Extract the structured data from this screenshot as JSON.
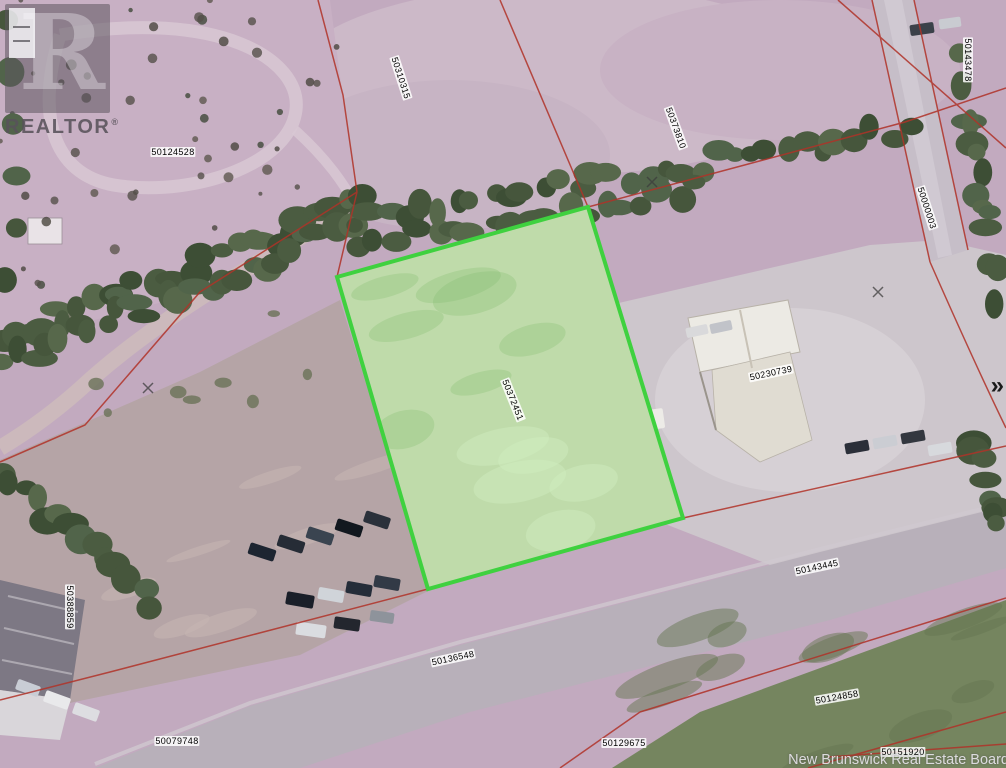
{
  "map": {
    "type": "aerial-parcel-map",
    "boundary_color": "#b03228",
    "highlight_parcel": {
      "id": "50372451",
      "border_color": "#3fd13f",
      "fill_color": "rgba(165,225,140,0.45)"
    },
    "parcel_labels": [
      {
        "id": "50124528",
        "x": 173,
        "y": 152,
        "rot": 0
      },
      {
        "id": "50310315",
        "x": 401,
        "y": 78,
        "rot": 72
      },
      {
        "id": "50373810",
        "x": 676,
        "y": 128,
        "rot": 70
      },
      {
        "id": "50143478",
        "x": 968,
        "y": 60,
        "rot": 90
      },
      {
        "id": "50000003",
        "x": 927,
        "y": 208,
        "rot": 72
      },
      {
        "id": "50230739",
        "x": 771,
        "y": 373,
        "rot": -12
      },
      {
        "id": "50372451",
        "x": 513,
        "y": 400,
        "rot": 68
      },
      {
        "id": "50388859",
        "x": 70,
        "y": 607,
        "rot": 90
      },
      {
        "id": "50143445",
        "x": 817,
        "y": 567,
        "rot": -12
      },
      {
        "id": "50136548",
        "x": 453,
        "y": 658,
        "rot": -12
      },
      {
        "id": "50079748",
        "x": 177,
        "y": 741,
        "rot": 0
      },
      {
        "id": "50124858",
        "x": 837,
        "y": 697,
        "rot": -10
      },
      {
        "id": "50129675",
        "x": 624,
        "y": 743,
        "rot": 0
      },
      {
        "id": "50151920",
        "x": 903,
        "y": 752,
        "rot": 0
      }
    ]
  },
  "watermarks": {
    "realtor_logo": {
      "glyph": "R",
      "text": "REALTOR",
      "registered": "®"
    },
    "attribution": "New Brunswick Real Estate Board"
  },
  "controls": {
    "next_chevron": "»"
  }
}
